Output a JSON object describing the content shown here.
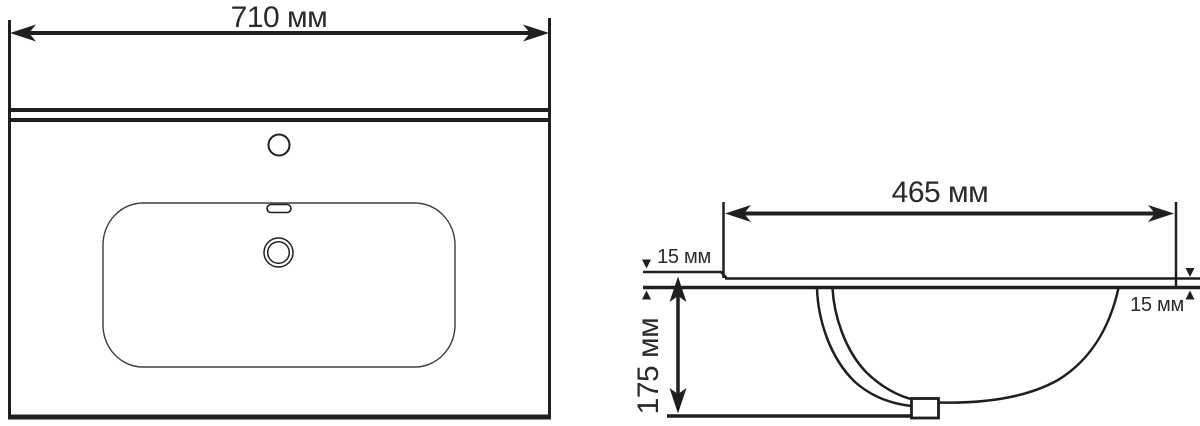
{
  "colors": {
    "line": "#1f1f1f",
    "thin_line": "#3d3d3d",
    "text": "#2a2a2a",
    "background": "#ffffff"
  },
  "front_view": {
    "width_dimension": "710 мм"
  },
  "side_view": {
    "depth_dimension": "465 мм",
    "left_edge_thickness": "15 мм",
    "right_edge_thickness": "15 мм",
    "basin_depth": "175 мм"
  }
}
